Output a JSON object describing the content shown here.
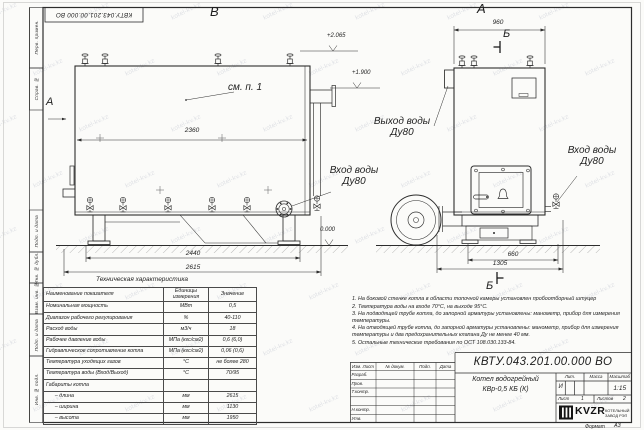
{
  "stamp_top": {
    "text": "КВТУ.043.201.00.000 ВО"
  },
  "margin_labels": [
    "Перв. примен.",
    "Справ. №",
    "Подп. и дата",
    "Инв. № дубл.",
    "Взам. инв. №",
    "Подп. и дата",
    "Инв. № подл."
  ],
  "watermark": {
    "text": "kotel-kv.kz"
  },
  "views": {
    "b": {
      "label": "В",
      "view_arrow": "А",
      "see_note": "см. п. 1",
      "dim_top": "2360",
      "dim_base": "2440",
      "dim_overall": "2615",
      "elev1": "+2.065",
      "elev2": "+1.900",
      "elev_zero": "0.000",
      "inlet_line1": "Вход воды",
      "inlet_line2": "Ду80"
    },
    "a": {
      "label": "А",
      "section_label_top": "Б",
      "section_label_bottom": "Б",
      "dim_top": "960",
      "dim_base": "660",
      "dim_overall": "1305",
      "outlet_line1": "Выход воды",
      "outlet_line2": "Ду80",
      "inlet_line1": "Вход воды",
      "inlet_line2": "Ду80"
    }
  },
  "table": {
    "title": "Техническая характеристика",
    "headers": [
      "Наименование показателя",
      "Единицы измерения",
      "Значение"
    ],
    "rows": [
      [
        "Номинальная мощность",
        "МВт",
        "0,5"
      ],
      [
        "Диапазон рабочего регулирования",
        "%",
        "40-110"
      ],
      [
        "Расход воды",
        "м3/ч",
        "18"
      ],
      [
        "Рабочее давление воды",
        "МПа (кгс/см2)",
        "0,6 (6,0)"
      ],
      [
        "Гидравлическое сопротивление котла",
        "МПа (кгс/см2)",
        "0,06 (0,6)"
      ],
      [
        "Температура уходящих газов",
        "°С",
        "не более 280"
      ],
      [
        "Температура воды (Вход/Выход)",
        "°С",
        "70/95"
      ],
      [
        "Габариты котла",
        "",
        ""
      ],
      [
        "      – длина",
        "мм",
        "2615"
      ],
      [
        "      – ширина",
        "мм",
        "1130"
      ],
      [
        "      – высота",
        "мм",
        "1950"
      ]
    ]
  },
  "notes": [
    "1. На боковой стенке котла в области топочной камеры установлен пробоотборный штуцер",
    "2. Температура воды на входе 70°С, на выходе 95°С.",
    "3. На подводящей трубе котла, до запорной арматуры установлены: манометр, прибор для измерения температуры.",
    "4. На отводящей трубе котла, до запорной арматуры установлены: манометр, прибор для измерения температуры и два предохранительных клапана Ду не менее 40 мм.",
    "5. Остальные технические требования по ОСТ 108.030.133-84."
  ],
  "titleblock": {
    "doc_number": "КВТУ.043.201.00.000 ВО",
    "product_name_line1": "Котел водогрейный",
    "product_name_line2": "КВр-0,5 КБ (К)",
    "col_izm": "Изм. Лист",
    "col_doc": "№ докум.",
    "col_podp": "Подп.",
    "col_data": "Дата",
    "row_labels": [
      "Разраб.",
      "Пров.",
      "Т.контр.",
      "",
      "Н.контр.",
      "Утв."
    ],
    "lit_header": "Лит.",
    "mass_header": "Масса",
    "scale_header": "Масштаб",
    "lit_value": "И",
    "scale_value": "1:15",
    "sheet_label": "Лист",
    "sheet_value": "1",
    "sheets_label": "Листов",
    "sheets_value": "2",
    "logo_text": "KVZR",
    "logo_sub1": "КОТЕЛЬНЫЙ",
    "logo_sub2": "ЗАВОД РЭП",
    "format_label": "Формат",
    "format_value": "А3"
  },
  "colors": {
    "line": "#2d2d2d",
    "accent_black": "#151515"
  }
}
